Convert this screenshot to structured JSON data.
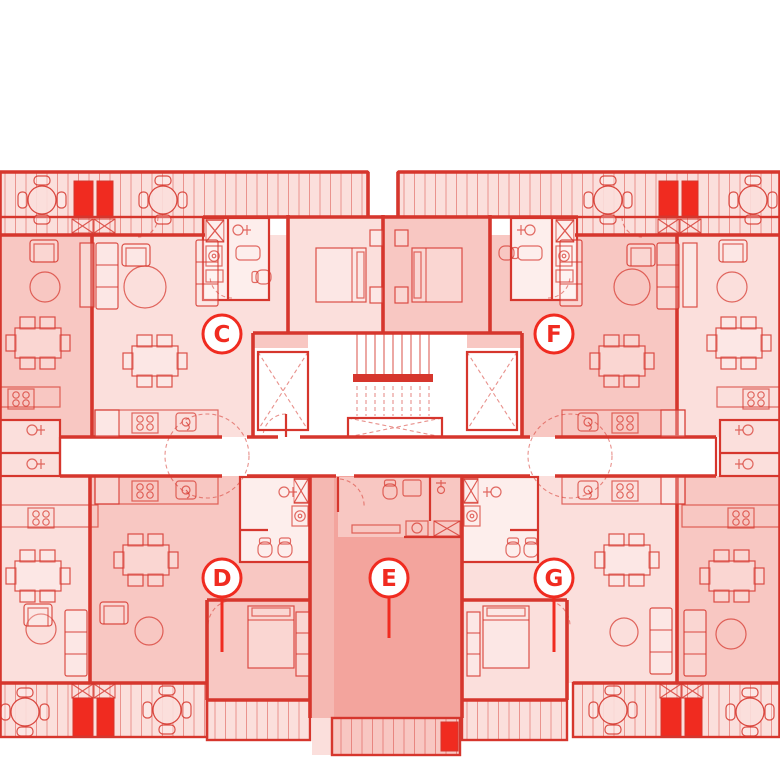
{
  "plan": {
    "type": "residential-floor-plan",
    "units": [
      {
        "label": "C"
      },
      {
        "label": "D"
      },
      {
        "label": "E"
      },
      {
        "label": "F"
      },
      {
        "label": "G"
      }
    ],
    "symbols": [
      "round-table",
      "dining-table",
      "sofa",
      "armchair",
      "coffee-table",
      "bed",
      "wardrobe",
      "stove",
      "kitchen-sink",
      "bathroom-sink",
      "toilet",
      "washing-machine",
      "shower",
      "elevator",
      "stairs",
      "balcony-deck",
      "door-swing"
    ]
  },
  "colors": {
    "paper": "#ffffff",
    "line": "#d6362d",
    "bright": "#f02b20",
    "light": "#fbdfdc",
    "mid": "#f8c7c2",
    "dark": "#f3a49d",
    "bath": "#fdeeec"
  }
}
